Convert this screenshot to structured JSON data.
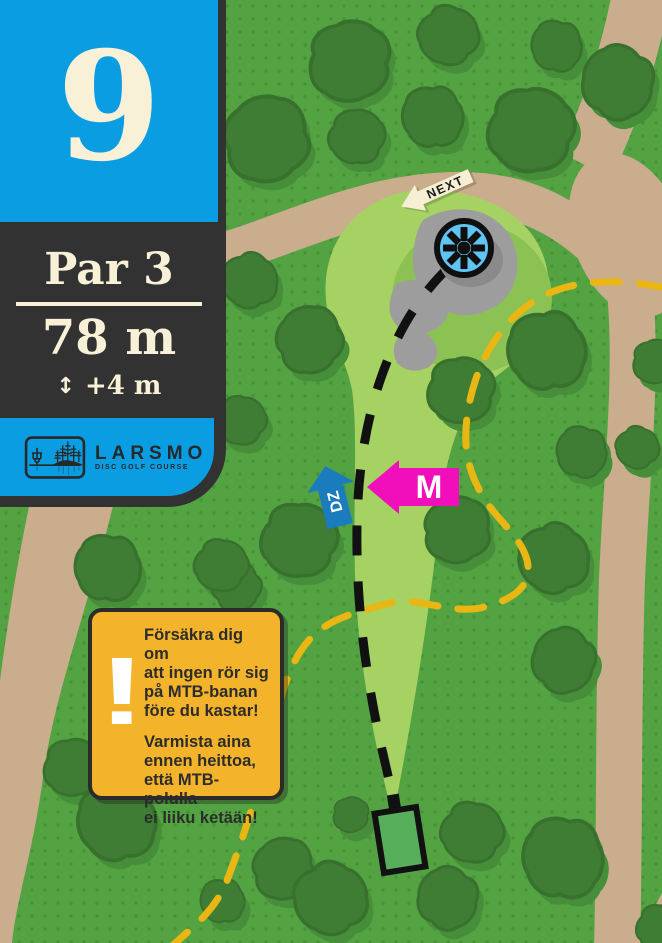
{
  "panel": {
    "hole_number": "9",
    "par_label": "Par 3",
    "distance_label": "78 m",
    "elevation_arrow": "↕",
    "elevation_label": "+4 m",
    "logo_name": "LARSMO",
    "logo_subtitle": "DISC GOLF COURSE"
  },
  "warning": {
    "exclamation": "!",
    "swedish_lines": [
      "Försäkra dig om",
      "att ingen rör sig",
      "på MTB-banan",
      "före du kastar!"
    ],
    "finnish_lines": [
      "Varmista aina",
      "ennen heittoa,",
      "että MTB-polulla",
      "ei liiku ketään!"
    ]
  },
  "map": {
    "signs": {
      "next": "NEXT",
      "dropzone": "DZ",
      "mandatory": "M"
    },
    "colors": {
      "accent_blue": "#0b9de1",
      "panel_dark": "#323232",
      "cream": "#f8f1d8",
      "warning_orange": "#f3b32a",
      "map_green": "#54a342",
      "fairway_green": "#a6d264",
      "fairway_accent_green": "#8cc253",
      "tree_green": "#3e7d33",
      "tree_shadow_green": "#478e3a",
      "path_tan": "#c9ad8d",
      "mtb_track_yellow": "#e9b613",
      "mandatory_magenta": "#f10fbc",
      "dropzone_blue": "#1a7cbd",
      "basket_blue": "#5fc3f3",
      "rock_gray": "#9d9d9d",
      "tee_green": "#57ae5b",
      "flight_line_black": "#111111"
    },
    "trees": [
      [
        350,
        62,
        0.95,
        0
      ],
      [
        448,
        36,
        0.7,
        40
      ],
      [
        556,
        46,
        0.6,
        95
      ],
      [
        266,
        138,
        1.0,
        160
      ],
      [
        357,
        136,
        0.65,
        200
      ],
      [
        432,
        117,
        0.72,
        80
      ],
      [
        531,
        131,
        1.0,
        15
      ],
      [
        617,
        82,
        0.85,
        120
      ],
      [
        249,
        281,
        0.65,
        60
      ],
      [
        309,
        339,
        0.78,
        150
      ],
      [
        241,
        421,
        0.58,
        30
      ],
      [
        546,
        351,
        0.92,
        75
      ],
      [
        461,
        391,
        0.78,
        10
      ],
      [
        581,
        452,
        0.6,
        100
      ],
      [
        637,
        448,
        0.5,
        45
      ],
      [
        457,
        529,
        0.78,
        170
      ],
      [
        553,
        559,
        0.82,
        60
      ],
      [
        299,
        541,
        0.88,
        20
      ],
      [
        236,
        586,
        0.58,
        140
      ],
      [
        107,
        568,
        0.78,
        90
      ],
      [
        221,
        566,
        0.62,
        30
      ],
      [
        563,
        660,
        0.75,
        130
      ],
      [
        234,
        656,
        0.58,
        100
      ],
      [
        73,
        768,
        0.68,
        10
      ],
      [
        116,
        822,
        0.92,
        70
      ],
      [
        283,
        868,
        0.72,
        160
      ],
      [
        330,
        899,
        0.85,
        50
      ],
      [
        351,
        815,
        0.42,
        0
      ],
      [
        447,
        898,
        0.72,
        120
      ],
      [
        472,
        833,
        0.72,
        30
      ],
      [
        562,
        858,
        0.95,
        90
      ],
      [
        655,
        362,
        0.52,
        0
      ],
      [
        222,
        901,
        0.52,
        80
      ],
      [
        660,
        928,
        0.55,
        20
      ]
    ]
  }
}
